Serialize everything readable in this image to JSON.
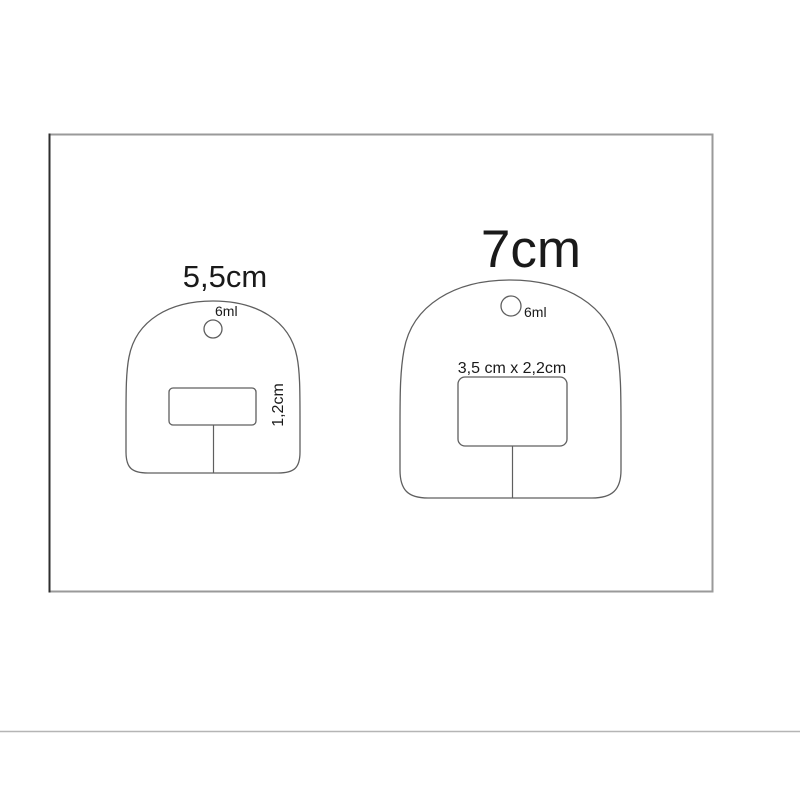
{
  "diagram": {
    "description": "size comparison drawing of two dome-shaped tag templates",
    "colors": {
      "background": "#ffffff",
      "outline": "#5f5f5f",
      "frame": "#9a9a9a",
      "frame_left_edge": "#2e2e2e",
      "divider": "#b5b5b5",
      "text": "#1a1a1a"
    },
    "templates": [
      {
        "name": "small",
        "size_label": "5,5cm",
        "hole_volume_label": "6ml",
        "slot_label": "1,2cm"
      },
      {
        "name": "large",
        "size_label": "7cm",
        "hole_volume_label": "6ml",
        "slot_label": "3,5 cm x 2,2cm"
      }
    ]
  }
}
